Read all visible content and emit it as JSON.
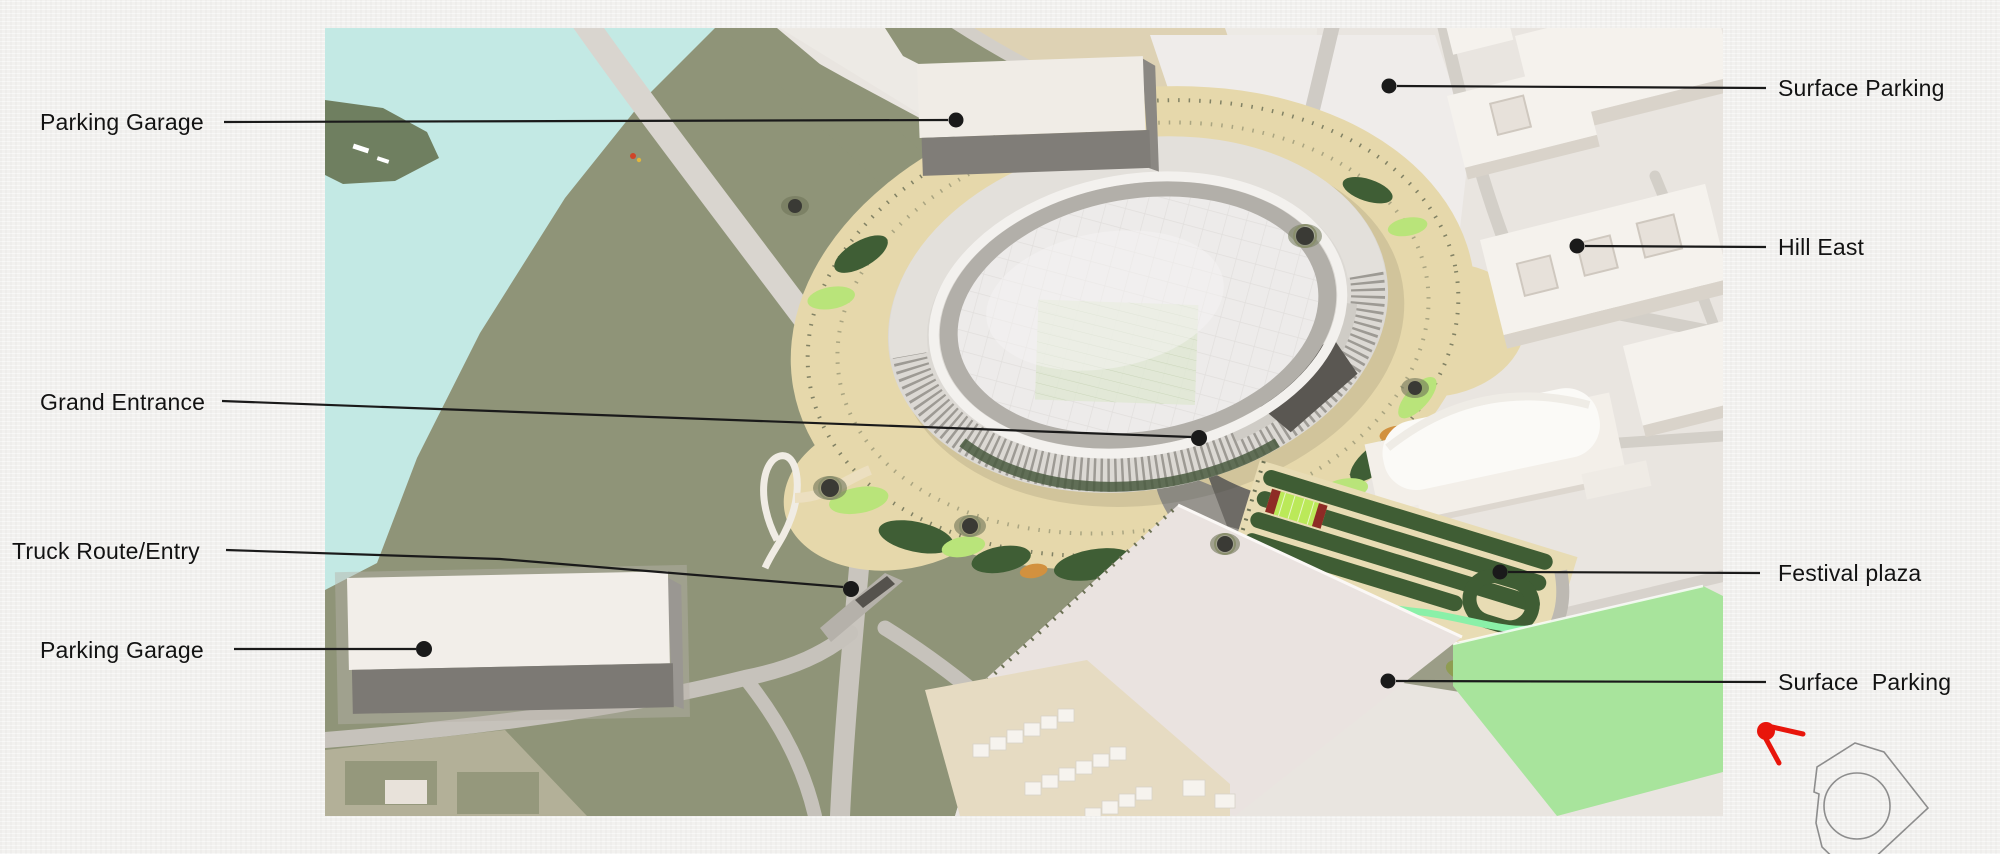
{
  "annotations": [
    {
      "label": "Parking Garage",
      "side": "left"
    },
    {
      "label": "Surface Parking",
      "side": "right"
    },
    {
      "label": "Hill East",
      "side": "right"
    },
    {
      "label": "Grand Entrance",
      "side": "left"
    },
    {
      "label": "Truck Route/Entry",
      "side": "left"
    },
    {
      "label": "Parking Garage",
      "side": "left"
    },
    {
      "label": "Festival plaza",
      "side": "right"
    },
    {
      "label": "Surface  Parking",
      "side": "right"
    }
  ],
  "colors": {
    "ink": "#141414",
    "accent_red": "#e8150b",
    "water": "#c3e9e4",
    "land_green": "#8f9478",
    "plaza_tan": "#e6d8ab",
    "lawn_dark_green": "#3f5d34",
    "field_mint_green": "#a8e49c",
    "urban_pale": "#e9e5e0",
    "building_white": "#f4f1ec",
    "garage_gray": "#7e7b76"
  }
}
